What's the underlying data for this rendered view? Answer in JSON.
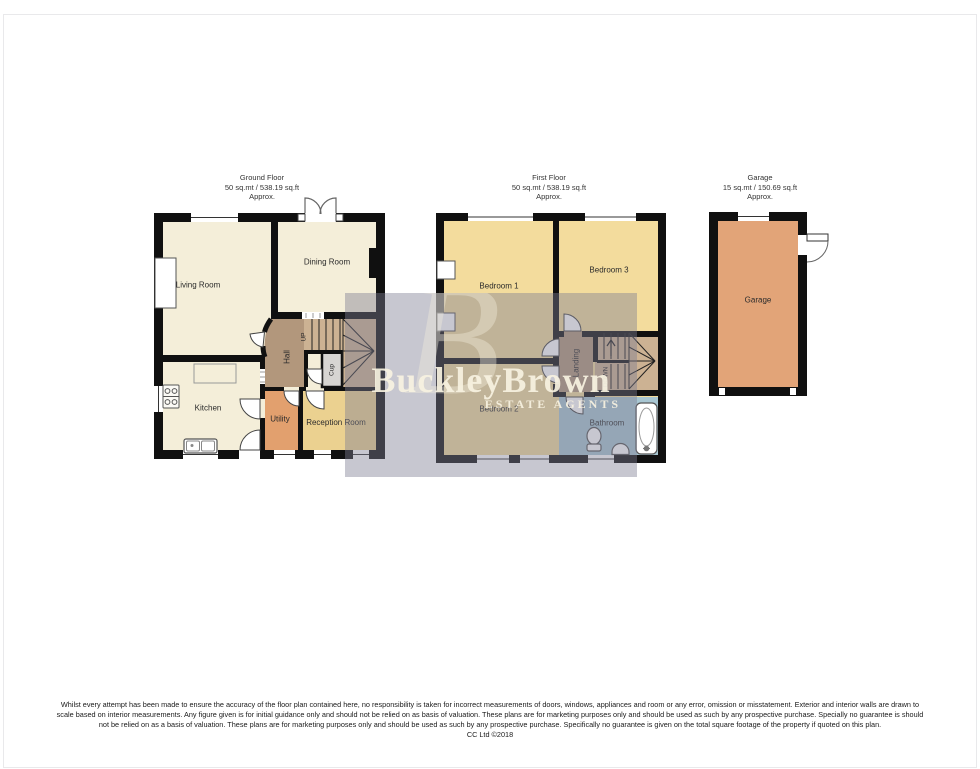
{
  "plans": {
    "ground_floor": {
      "title": "Ground Floor",
      "area": "50 sq.mt / 538.19 sq.ft",
      "approx": "Approx.",
      "rooms": {
        "living": "Living Room",
        "dining": "Dining Room",
        "kitchen": "Kitchen",
        "hall": "Hall",
        "up": "UP",
        "cup": "Cup",
        "utility": "Utility",
        "reception": "Reception Room"
      }
    },
    "first_floor": {
      "title": "First Floor",
      "area": "50 sq.mt / 538.19 sq.ft",
      "approx": "Approx.",
      "rooms": {
        "bedroom1": "Bedroom 1",
        "bedroom2": "Bedroom 2",
        "bedroom3": "Bedroom 3",
        "landing": "Landing",
        "down": "DOWN",
        "bathroom": "Bathroom"
      }
    },
    "garage": {
      "title": "Garage",
      "area": "15 sq.mt / 150.69 sq.ft",
      "approx": "Approx.",
      "rooms": {
        "garage": "Garage"
      }
    }
  },
  "watermark": {
    "brand": "BuckleyBrown",
    "tagline": "ESTATE AGENTS",
    "monogram": "B"
  },
  "disclaimer": {
    "line1": "Whilst every attempt has been made to ensure the accuracy of the floor plan contained here, no responsibility is taken for incorrect measurements of doors, windows, appliances and room or any error, omission or misstatement. Exterior and interior walls are drawn to",
    "line2": "scale based on interior measurements. Any figure given is for initial guidance only and should not be relied on as basis of valuation. These plans are for marketing purposes only and should be used as such by any prospective purchase. Specially no guarantee is should",
    "line3": "not be relied on as a basis of valuation. These plans are for marketing purposes only and should be used as such by any prospective purchase. Specifically no guarantee is given on the total square footage of the property if quoted on this plan.",
    "copyright": "CC Ltd ©2018"
  },
  "colors": {
    "cream": "#f4eed9",
    "hall": "#b2977c",
    "stairs": "#ccb293",
    "cup": "#d7d5d2",
    "utility": "#e2a06e",
    "reception": "#ebd190",
    "bedroom": "#f3dc9d",
    "bathroom": "#a8c6d2",
    "garage": "#e2a478",
    "wall": "#101010",
    "label": "#2b2b2b",
    "frame": "#e9e9eb",
    "wm": "rgba(125,125,147,0.43)",
    "wm_text": "rgba(247,242,225,0.92)",
    "wm_mono": "rgba(242,237,220,0.40)"
  }
}
